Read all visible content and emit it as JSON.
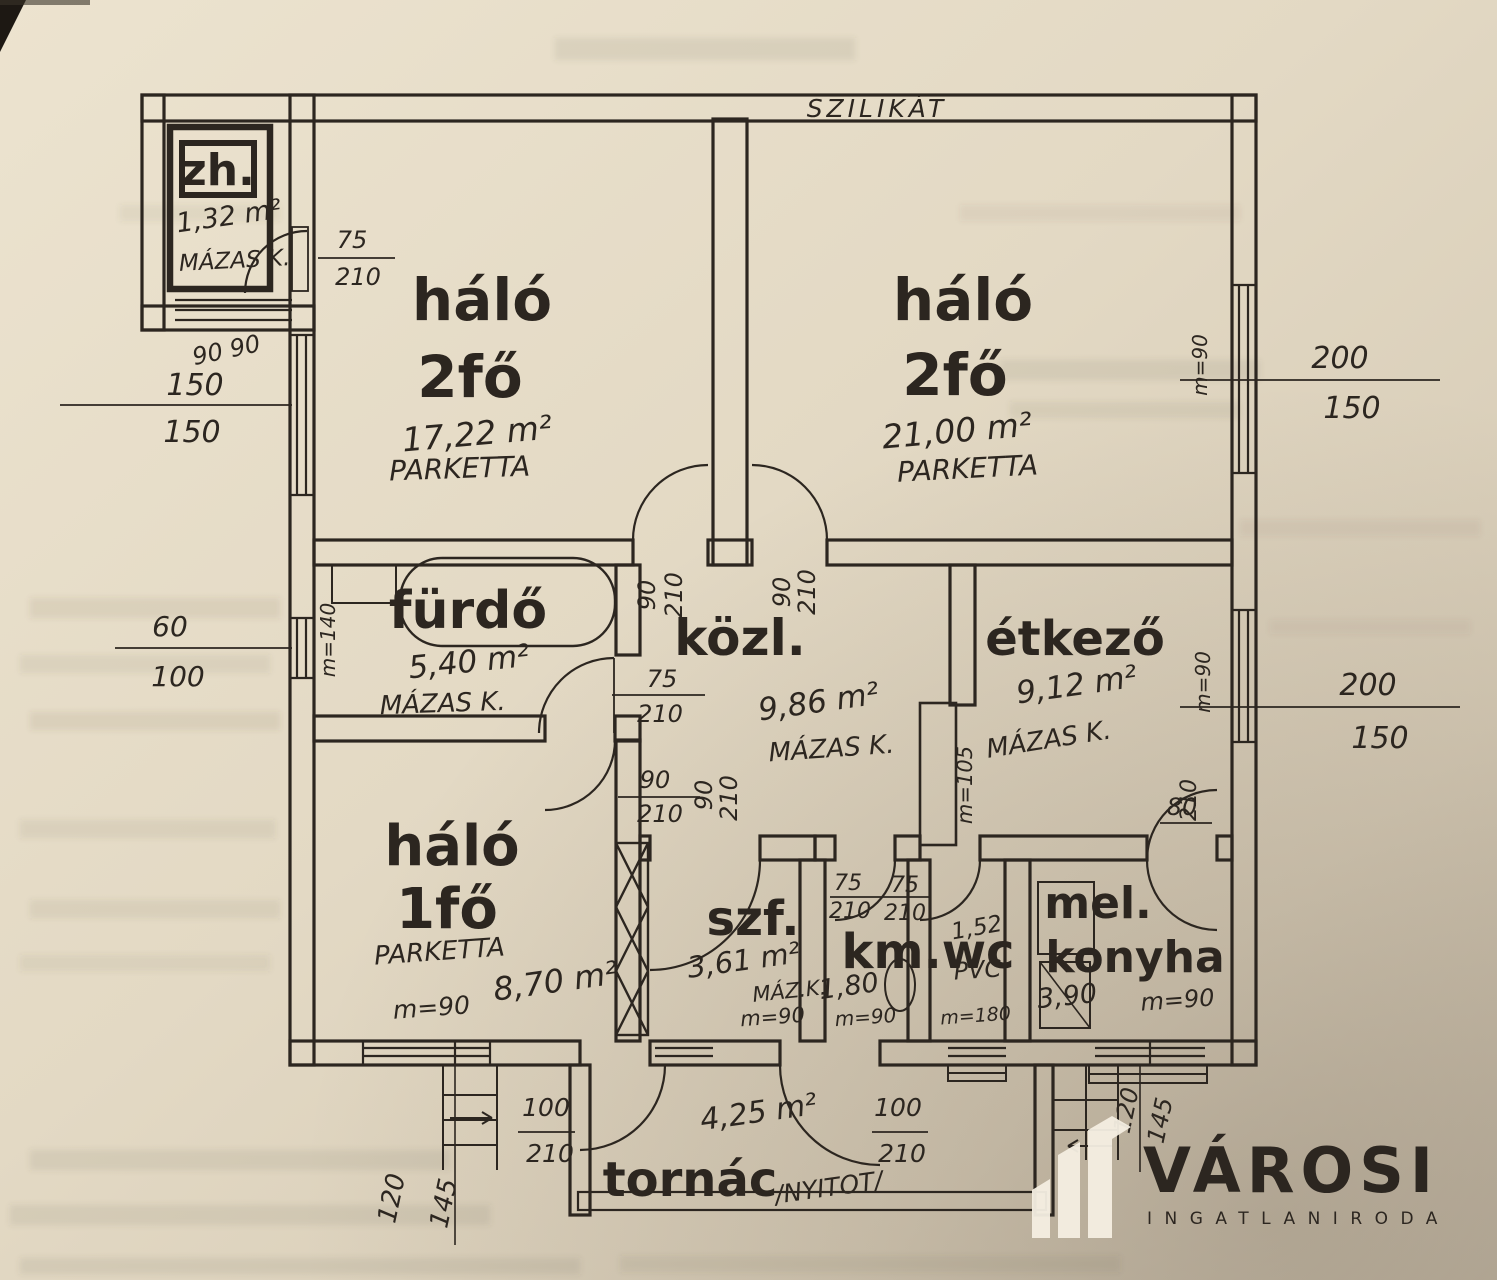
{
  "plan": {
    "material_note": "SZILIKÁT",
    "rooms": {
      "zh": {
        "name": "zh.",
        "area": "1,32 m²",
        "floor": "MÁZAS K."
      },
      "halo_a": {
        "name": "háló",
        "occupancy": "2fő",
        "area": "17,22 m²",
        "floor": "PARKETTA"
      },
      "halo_b": {
        "name": "háló",
        "occupancy": "2fő",
        "area": "21,00 m²",
        "floor": "PARKETTA"
      },
      "furdo": {
        "name": "fürdő",
        "area": "5,40 m²",
        "floor": "MÁZAS K."
      },
      "kozl": {
        "name": "közl.",
        "area": "9,86 m²",
        "floor": "MÁZAS K."
      },
      "etkezo": {
        "name": "étkező",
        "area": "9,12 m²",
        "floor": "MÁZAS K."
      },
      "halo_c": {
        "name": "háló",
        "occupancy": "1fő",
        "area": "8,70 m²",
        "floor": "PARKETTA",
        "height": "m=90"
      },
      "szf": {
        "name": "szf.",
        "area": "3,61 m²",
        "floor": "MÁZ.K.",
        "height": "m=90"
      },
      "kmwc": {
        "name": "km.wc",
        "km_area": "1,80",
        "wc_area": "1,52",
        "floor": "PVC",
        "km_height": "m=90",
        "wc_height": "m=180"
      },
      "mel": {
        "line1": "mel.",
        "line2": "konyha",
        "area": "3,90",
        "height": "m=90"
      },
      "tornac": {
        "name": "tornác",
        "area": "4,25 m²",
        "note": "/NYITOT/"
      }
    },
    "dims": {
      "zh_door_w": "75",
      "zh_door_h": "210",
      "win_left1_w": "150",
      "win_left1_h": "150",
      "win_left1_p": "90  90",
      "win_left2_w": "60",
      "win_left2_h": "100",
      "win_left2_p": "m=140",
      "win_right1_w": "200",
      "win_right1_h": "150",
      "win_right1_p": "m=90",
      "win_right2_w": "200",
      "win_right2_h": "150",
      "win_right2_p": "m=90",
      "furdo_door_w": "75",
      "furdo_door_h": "210",
      "kozl_door1_w": "90",
      "kozl_door1_h": "210",
      "kozl_door2_w": "90",
      "kozl_door2_h": "210",
      "halo1_door_w": "90",
      "halo1_door_h": "210",
      "halo1_door2_w": "90",
      "halo1_door2_h": "210",
      "etkezo_door_w": "80",
      "etkezo_door_h": "210",
      "km_door_w": "75",
      "km_door_h": "210",
      "wc_door_w": "75",
      "wc_door_h": "210",
      "tornac_door_l_w": "100",
      "tornac_door_l_h": "210",
      "tornac_door_r_w": "100",
      "tornac_door_r_h": "210",
      "stair_l_a": "120",
      "stair_l_b": "145",
      "stair_r_a": "120",
      "stair_r_b": "145",
      "chimney_h": "m=105"
    },
    "colors": {
      "paper": "#e7ddc8",
      "ink": "#2c2620",
      "logo_text": "#f5efe2"
    }
  },
  "logo": {
    "brand": "VÁROSI",
    "tagline": "INGATLANIRODA"
  }
}
